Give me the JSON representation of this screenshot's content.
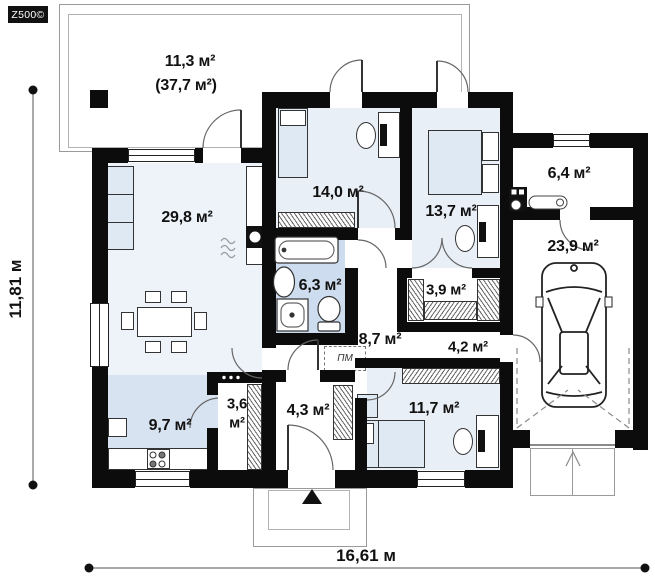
{
  "logo": {
    "brand": "Z500©"
  },
  "dimensions": {
    "height": "11,81 м",
    "width": "16,61 м"
  },
  "terrace": {
    "area": "11,3 м²",
    "total_area": "(37,7 м²)"
  },
  "rooms": {
    "living": {
      "area": "29,8 м²"
    },
    "bedroom_top": {
      "area": "14,0 м²"
    },
    "bedroom_right": {
      "area": "13,7 м²"
    },
    "bathroom": {
      "area": "6,3 м²"
    },
    "wardrobe": {
      "area": "3,9 м²"
    },
    "hallway": {
      "area": "8,7 м²"
    },
    "corridor": {
      "area": "4,2 м²"
    },
    "kitchen": {
      "area": "9,7 м²"
    },
    "pantry": {
      "area_line1": "3,6",
      "area_line2": "м²"
    },
    "vestibule": {
      "area": "4,3 м²"
    },
    "bedroom_bottom": {
      "area": "11,7 м²"
    },
    "utility": {
      "area": "6,4 м²"
    },
    "garage": {
      "area": "23,9 м²"
    }
  },
  "appliances": {
    "washing_machine": "ПМ"
  },
  "colors": {
    "wall": "#0c0c0c",
    "bedroom_floor": "#e9eff7",
    "bathroom_floor": "#cddcee",
    "kitchen_floor": "#d8e3f1",
    "furniture_blue": "#dfe9f4"
  }
}
